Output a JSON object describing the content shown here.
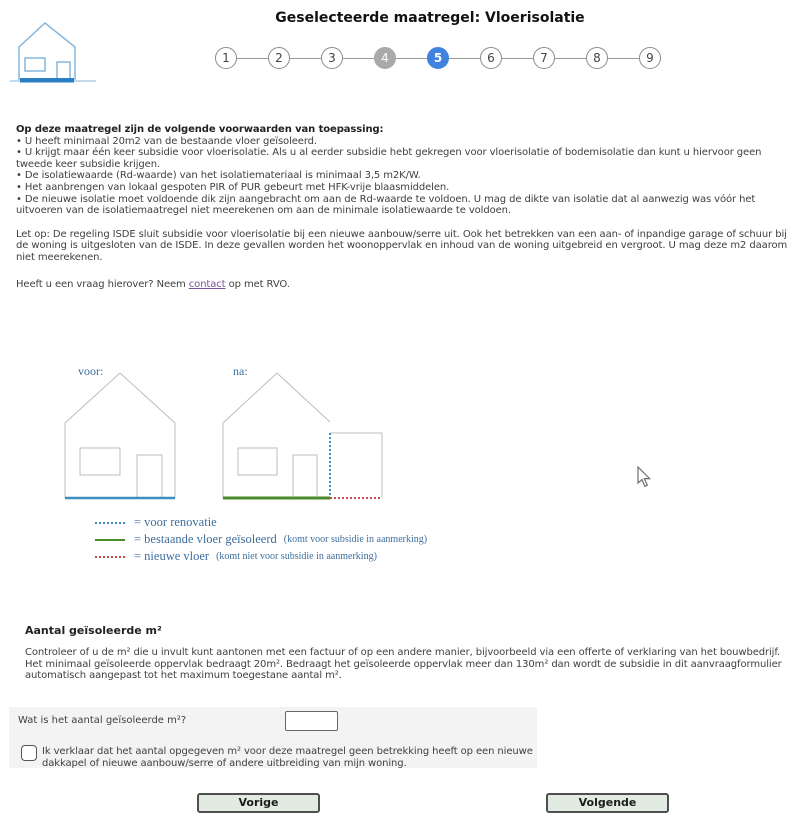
{
  "header": {
    "title": "Geselecteerde maatregel: Vloerisolatie"
  },
  "stepper": {
    "steps": [
      "1",
      "2",
      "3",
      "4",
      "5",
      "6",
      "7",
      "8",
      "9"
    ],
    "active_step": "5",
    "completed_step": "4"
  },
  "conditions": {
    "intro": "Op deze maatregel zijn de volgende voorwaarden van toepassing:",
    "bullets": [
      "• U heeft minimaal 20m2 van de bestaande vloer geïsoleerd.",
      "• U krijgt maar één keer subsidie voor vloerisolatie. Als u al eerder subsidie hebt gekregen voor vloerisolatie of bodemisolatie dan kunt u hiervoor geen tweede keer subsidie krijgen.",
      "• De isolatiewaarde (Rd-waarde) van het isolatiemateriaal is minimaal 3,5 m2K/W.",
      "• Het aanbrengen van lokaal gespoten PIR of PUR gebeurt met HFK-vrije blaasmiddelen.",
      "• De nieuwe isolatie moet voldoende dik zijn aangebracht om aan de Rd-waarde te voldoen. U mag de dikte van isolatie dat al aanwezig was vóór het uitvoeren van de isolatiemaatregel niet meerekenen om aan de minimale isolatiewaarde te voldoen."
    ]
  },
  "note": "Let op: De regeling ISDE sluit subsidie voor vloerisolatie bij een nieuwe aanbouw/serre uit. Ook het betrekken van een aan- of inpandige garage of schuur bij de woning is uitgesloten van de ISDE. In deze gevallen worden het woonoppervlak en inhoud van de woning uitgebreid en vergroot. U mag deze m2 daarom niet meerekenen.",
  "contact_line": {
    "before": "Heeft u een vraag hierover? Neem ",
    "link_label": "contact",
    "after": " op met RVO."
  },
  "diagram": {
    "label_before": "voor:",
    "label_after": "na:",
    "legend": [
      {
        "label": "= voor renovatie",
        "note": ""
      },
      {
        "label": "= bestaande vloer geïsoleerd",
        "note": "(komt voor subsidie in aanmerking)"
      },
      {
        "label": "= nieuwe vloer",
        "note": "(komt niet voor subsidie in aanmerking)"
      }
    ],
    "colors": {
      "before_renovation": "#3e8fc0",
      "existing_floor_insulated": "#4a8c2a",
      "new_floor": "#c0504d",
      "house_outline": "#bcbcbc"
    }
  },
  "m2_section": {
    "heading": "Aantal geïsoleerde m²",
    "body": "Controleer of u de m² die u invult kunt aantonen met een factuur of op een andere manier, bijvoorbeeld via een offerte of verklaring van het bouwbedrijf. Het minimaal geïsoleerde oppervlak bedraagt 20m². Bedraagt het geïsoleerde oppervlak meer dan 130m² dan wordt de subsidie in dit aanvraagformulier automatisch aangepast tot het maximum toegestane aantal m²."
  },
  "form": {
    "question_label": "Wat is het aantal geïsoleerde m²?",
    "input_value": "",
    "checkbox_label": "Ik verklaar dat het aantal opgegeven m² voor deze maatregel geen betrekking heeft op een nieuwe dakkapel of nieuwe aanbouw/serre of andere uitbreiding van mijn woning.",
    "checkbox_checked": false
  },
  "buttons": {
    "previous": "Vorige",
    "next": "Volgende"
  },
  "colors": {
    "step_active": "#3f82e0",
    "step_completed": "#a9a9a9",
    "link": "#7b4f9e",
    "panel_bg": "#f3f3f3",
    "logo_outline": "#85b7dc",
    "logo_floor": "#2b7fc2"
  }
}
